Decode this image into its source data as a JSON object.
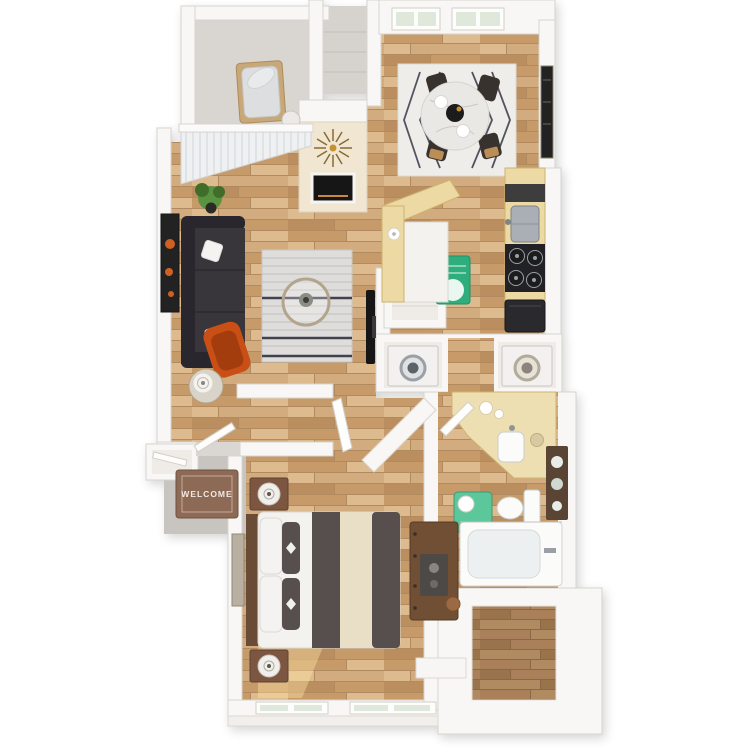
{
  "labels": {
    "welcome_mat": "WELCOME"
  },
  "colors": {
    "page_bg": "#ffffff",
    "wall": "#f8f7f5",
    "wall_stroke": "#d8d4ce",
    "cream_wall": "#f0e6d2",
    "wood_seam": "#b28a5e",
    "wood_a": "#d2ab7e",
    "wood_b": "#c69a69",
    "wood_c": "#ddbb8e",
    "wood_d": "#ba8e5f",
    "wood_dark_seam": "#8a6844",
    "wood_dark_a": "#a9805a",
    "wood_dark_b": "#99734c",
    "wood_dark_c": "#b08a60",
    "balcony_floor": "#d9d6d1",
    "shaft_floor": "#d6d3ce",
    "pad_floor": "#c8c5c0",
    "niche_floor": "#efece7",
    "sofa": "#38343a",
    "sofa_dark": "#2a282d",
    "pillow_white": "#f4f3f1",
    "accent_chair": "#c94f15",
    "accent_chair_dark": "#a33d0c",
    "rug_living": "#dedddb",
    "rug_living_stripe": "#bfbebc",
    "rug_living_navy": "#43434f",
    "rug_dining": "#efede9",
    "rug_dining_line": "#52525e",
    "marble": "#eae8e4",
    "marble_vein": "#cac8c4",
    "chair_dark": "#37322f",
    "chair_seat": "#bb8e57",
    "glass_rim": "#b3a58b",
    "counter": "#ecd9a4",
    "counter_stroke": "#cdb470",
    "cooktop": "#232325",
    "steel": "#a9afb4",
    "fridge": "#2c2c2f",
    "appliance_white": "#f2f1ef",
    "green_rug": "#2fae7c",
    "bath_mat": "#5cc79a",
    "vanity": "#eedfb2",
    "porcelain": "#fbfbfa",
    "tub_inner": "#edf0f1",
    "shelf_dark": "#5a4434",
    "mat_brown": "#8d6b55",
    "mat_brown_dark": "#6f523f",
    "mat_text": "#f2e9e2",
    "bed_white": "#f4f2ef",
    "bed_dark": "#57504e",
    "bed_cream": "#e9dec6",
    "headboard": "#6a4c36",
    "nightstand": "#7b5640",
    "dresser": "#6f4f36",
    "tray_dark": "#4e4a46",
    "art_dark": "#232020",
    "art_orange": "#d06022",
    "plant": "#5a9340",
    "plant_dark": "#3f6e2a",
    "window_glass": "#dfe8da",
    "blind": "#eef0f2",
    "blind_line": "#d2d6da",
    "fireplace": "#161412",
    "ember": "#c9883a",
    "starburst": "#8a6a34",
    "sun": "#ffe3a1",
    "tv": "#141316",
    "door_leaf": "#fdfdfc"
  }
}
